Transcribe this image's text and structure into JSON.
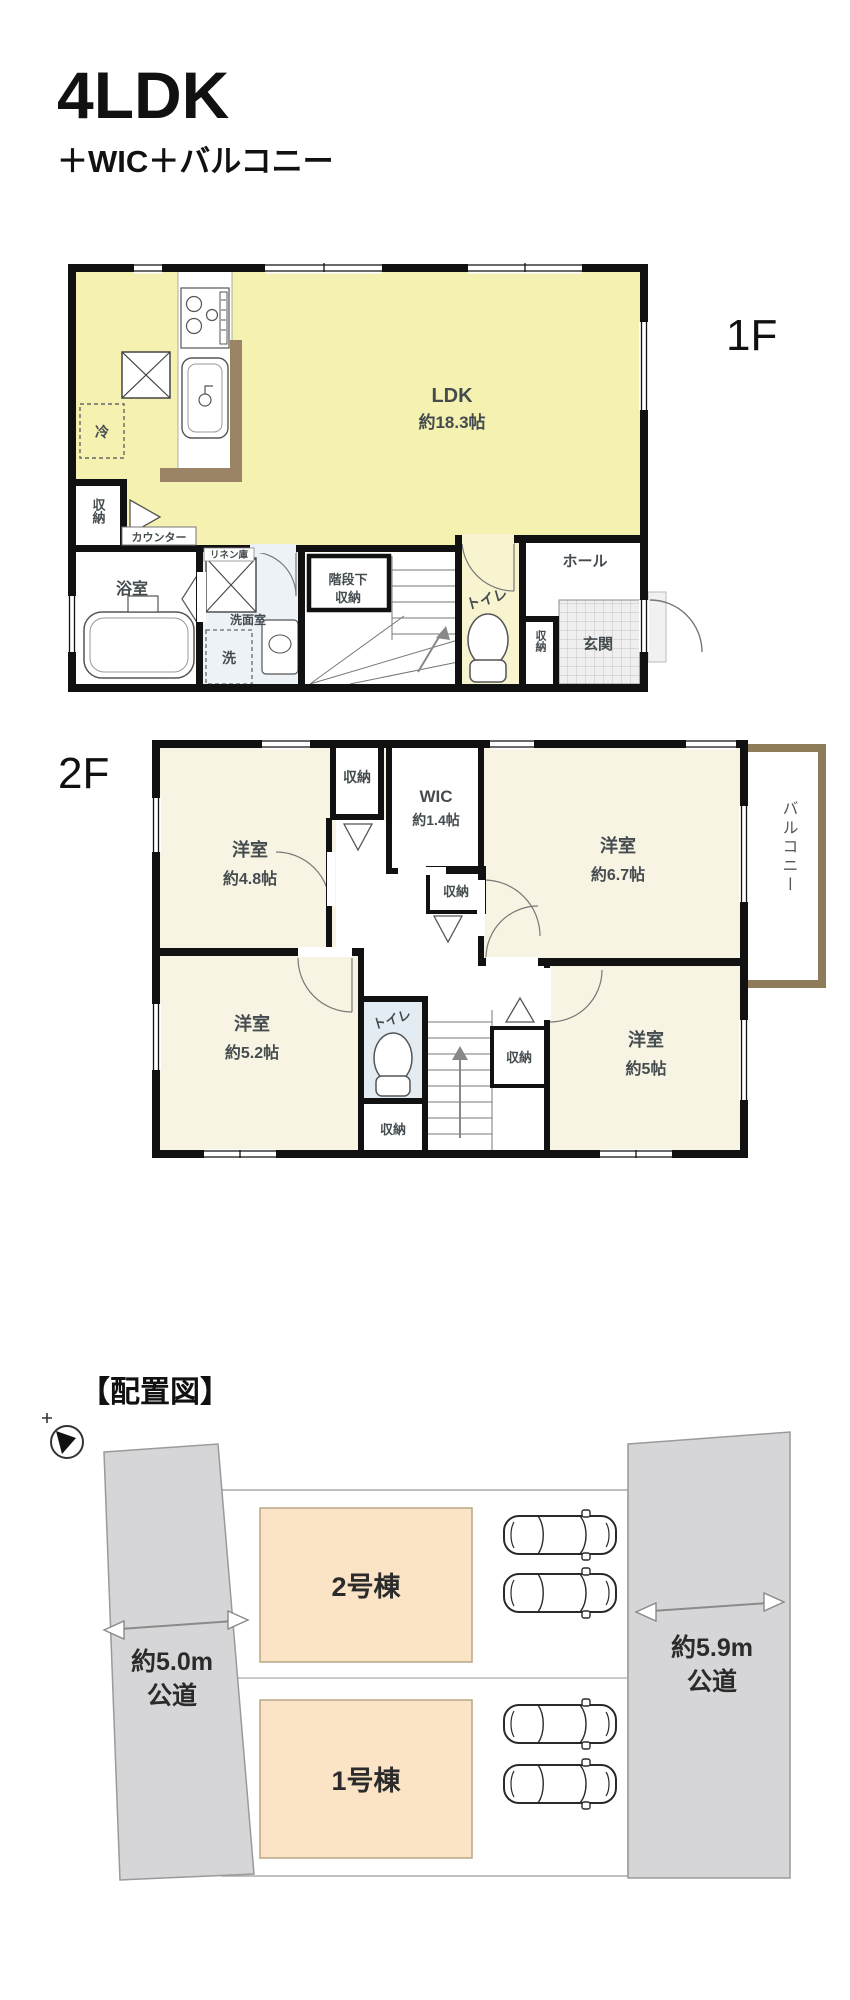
{
  "header": {
    "title": "4LDK",
    "subtitle": "＋WIC＋バルコニー"
  },
  "floor1": {
    "floor_label": "1F",
    "ldk_name": "LDK",
    "ldk_size": "約18.3帖",
    "fridge": "冷",
    "storage": "収納",
    "counter": "カウンター",
    "linen": "リネン庫",
    "bath": "浴室",
    "washroom": "洗面室",
    "laundry": "洗",
    "under_stair_line1": "階段下",
    "under_stair_line2": "収納",
    "toilet": "トイレ",
    "hall": "ホール",
    "entry_storage": "収納",
    "entrance": "玄関"
  },
  "floor2": {
    "floor_label": "2F",
    "bed1_name": "洋室",
    "bed1_size": "約4.8帖",
    "bed2_name": "洋室",
    "bed2_size": "約6.7帖",
    "bed3_name": "洋室",
    "bed3_size": "約5.2帖",
    "bed4_name": "洋室",
    "bed4_size": "約5帖",
    "wic_name": "WIC",
    "wic_size": "約1.4帖",
    "closet_top": "収納",
    "closet_mid": "収納",
    "closet_stairs": "収納",
    "closet_bottom": "収納",
    "toilet": "トイレ",
    "balcony": "バルコニー"
  },
  "site_plan": {
    "heading": "【配置図】",
    "building_2": "2号棟",
    "building_1": "1号棟",
    "road_left_width": "約5.0m",
    "road_left_type": "公道",
    "road_right_width": "約5.9m",
    "road_right_type": "公道"
  },
  "colors": {
    "ldk_yellow": "#f5f1b0",
    "toilet1_cream": "#f7f4cf",
    "cream": "#f8f4e3",
    "toilet_blue": "#e3ecf3",
    "washroom_blue": "#edf2f7",
    "counter_wood": "#9b8466",
    "balcony_frame": "#8d7b5a",
    "road_gray": "#d6d6d8",
    "building_peach": "#fbe4c6",
    "wall_black": "#111111"
  }
}
